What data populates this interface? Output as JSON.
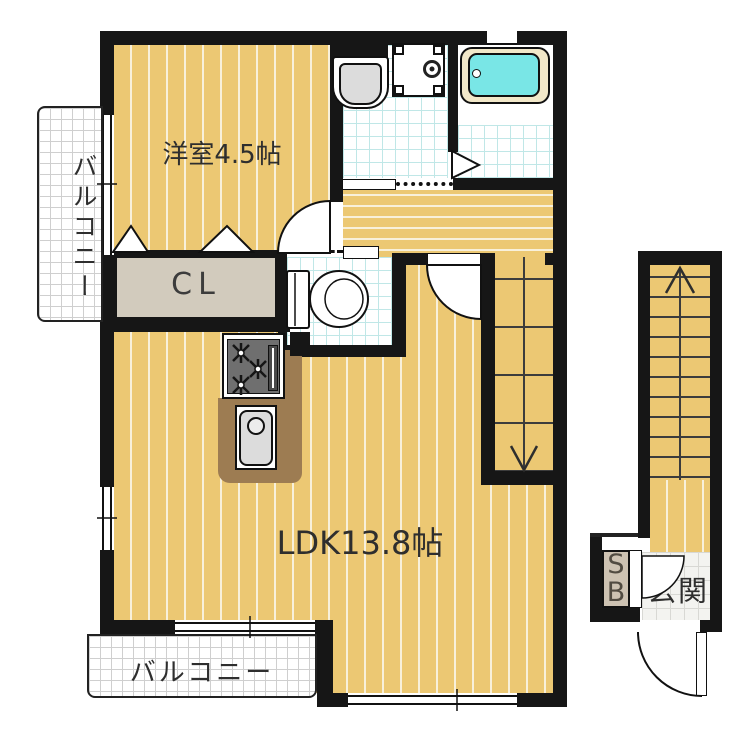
{
  "rooms": {
    "western_room": {
      "label": "洋室4.5帖"
    },
    "ldk": {
      "label": "LDK13.8帖"
    },
    "closet": {
      "label": "CL"
    },
    "balcony_left": {
      "label": "バルコニー"
    },
    "balcony_bottom": {
      "label": "バルコニー"
    },
    "entrance": {
      "label": "玄関"
    },
    "shoe_box": {
      "label_top": "S",
      "label_bottom": "B"
    }
  },
  "colors": {
    "wall": "#161616",
    "floor": "#ecc873",
    "floor_stripe": "#f8f0da",
    "closet": "#d2cbbd",
    "shoe_box": "#cdc2b2",
    "counter": "#9d7c52",
    "stove": "#6f6f6f",
    "fixture_gray": "#dcdcdc",
    "tub": "#79e6e6",
    "tub_rim": "#f2e8c9",
    "wet_grid": "#c0e7e7",
    "balcony_grid": "#cfcfcf",
    "tile_bg": "#f3f3f0",
    "tile_grid": "#d8d8d4",
    "text": "#2e2e2e"
  }
}
